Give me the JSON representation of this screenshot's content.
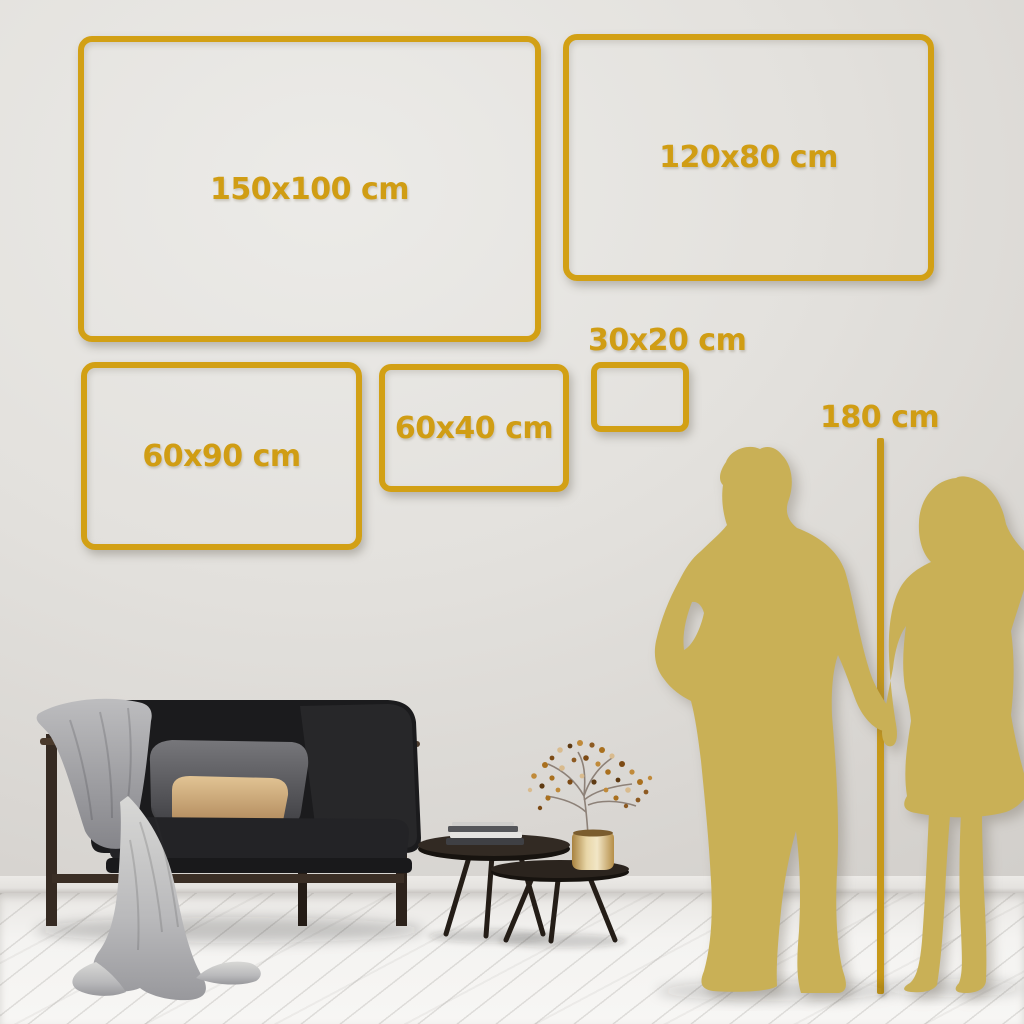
{
  "sizes": [
    {
      "label": "150x100 cm"
    },
    {
      "label": "120x80 cm"
    },
    {
      "label": "60x90 cm"
    },
    {
      "label": "60x40 cm"
    },
    {
      "label": "30x20 cm"
    }
  ],
  "height_marker": {
    "label": "180 cm"
  },
  "palette": {
    "gold_frame": "#D2A015",
    "gold_text": "#D09D14",
    "gold_line": "#C7991A",
    "silhouette": "#C9B056",
    "wall": "#E0DDD9",
    "floor": "#F4F3F1",
    "sofa_dark": "#1C1C1E",
    "pillow_tan": "#D3AE7C",
    "blanket_gray": "#9B9B9D"
  },
  "scene_elements": [
    "man-silhouette",
    "woman-silhouette",
    "sofa",
    "throw-blanket",
    "coffee-tables",
    "books",
    "brass-vase",
    "berry-plant",
    "height-line"
  ]
}
